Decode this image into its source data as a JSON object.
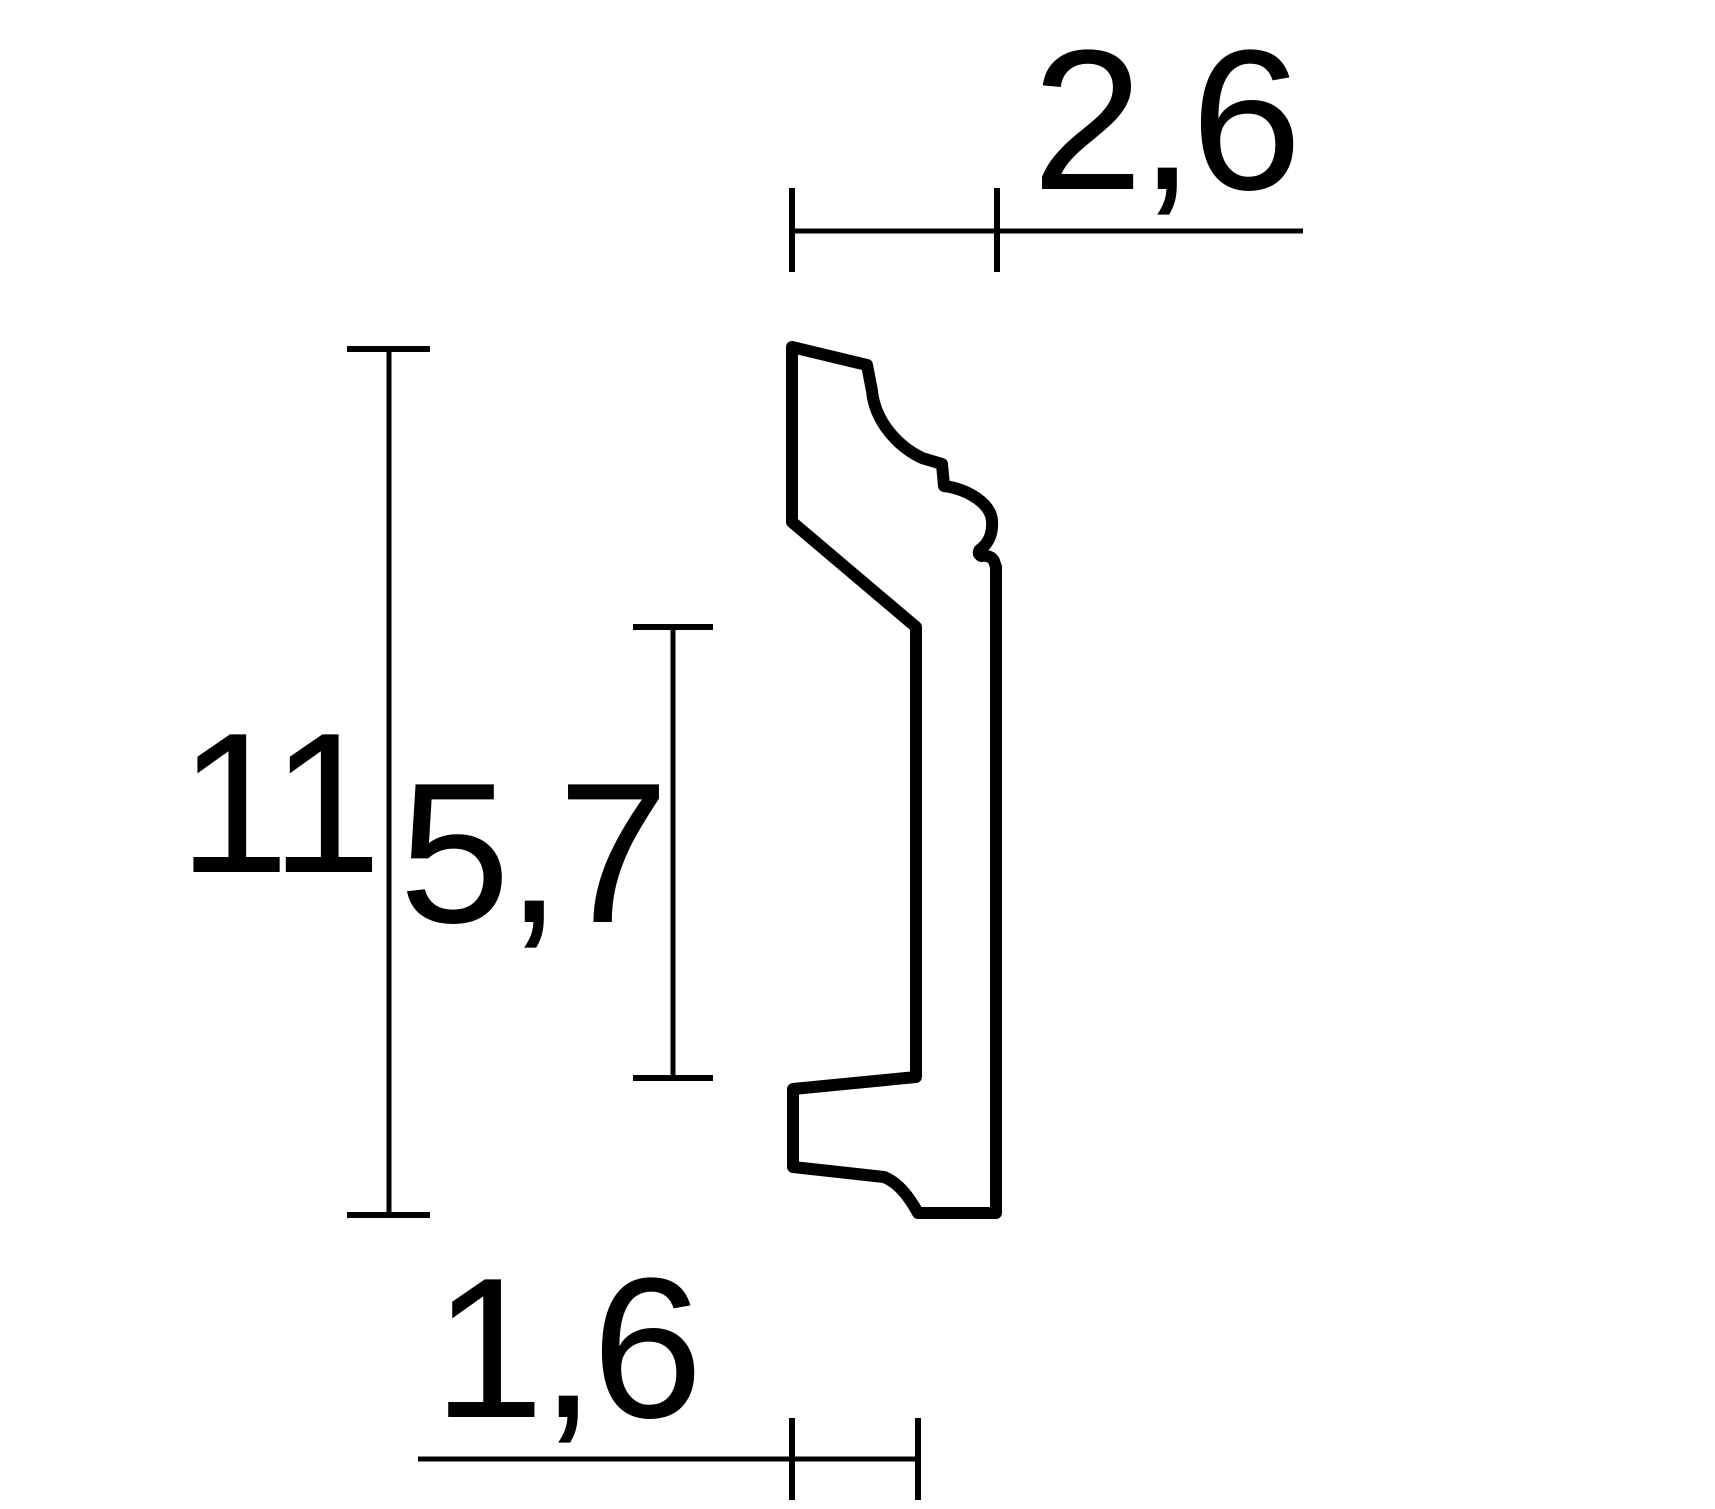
{
  "drawing": {
    "description": "Technical cross-section drawing of a moulding profile with dimension lines",
    "unit_labels": {
      "top_width": "2,6",
      "total_height": "11",
      "middle_height": "5,7",
      "bottom_width": "1,6"
    },
    "colors": {
      "background": "#ffffff",
      "line": "#000000"
    }
  }
}
